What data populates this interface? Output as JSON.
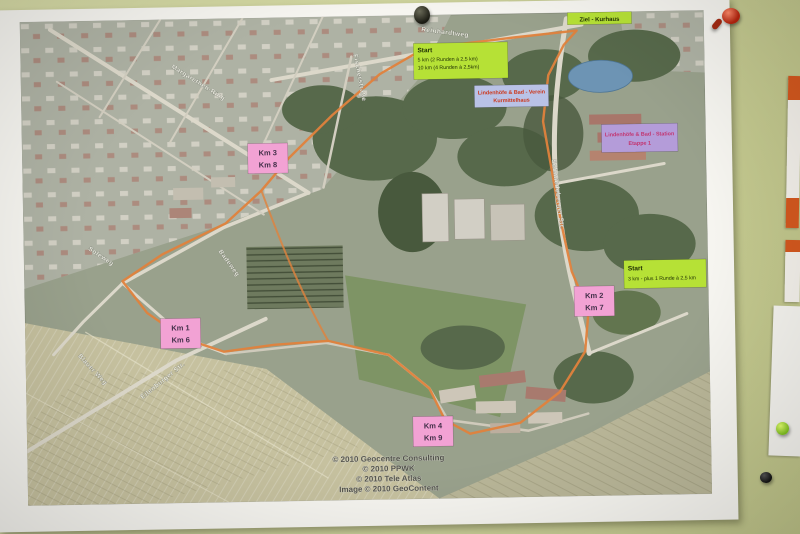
{
  "photo": {
    "labels": {
      "start_main": {
        "title": "Start",
        "line1": "5 km (2 Runden à 2,5 km)",
        "line2": "10 km (4 Runden à 2,5km)"
      },
      "finish": {
        "text": "Ziel - Kurhaus"
      },
      "club": {
        "line1": "Lindenhöfe & Bad - Verein",
        "line2": "Kurmittelhaus"
      },
      "station": {
        "line1": "Lindenhöfe & Bad - Station",
        "line2": "Etappe 1"
      },
      "start_right": {
        "title": "Start",
        "line1": "3 km - plus 1 Runde à 2,5 km"
      }
    },
    "km_markers": [
      {
        "top": "Km 3",
        "bottom": "Km 8"
      },
      {
        "top": "Km 1",
        "bottom": "Km 6"
      },
      {
        "top": "Km 2",
        "bottom": "Km 7"
      },
      {
        "top": "Km 4",
        "bottom": "Km 9"
      }
    ],
    "streets": {
      "reinhardtweg": "Reinhardtweg",
      "margarethen_ring": "Margarethen-Ring",
      "fischerstrasse": "Fischerstraße",
      "soleweg": "Soleweg",
      "badeweg": "Badeweg",
      "blauer_weg": "Blauer Weg",
      "eilenburger_str": "Eilenburger Str.",
      "schmiedeberger_str": "Schmiedeberger Str."
    },
    "copyright": {
      "line1": "© 2010 Geocentre Consulting",
      "line2": "© 2010 PPWK",
      "line3": "© 2010 Tele Atlas",
      "line4": "Image © 2010 GeoContent"
    },
    "colors": {
      "route": "#e0823c",
      "km_box": "#f2a2d4",
      "start_box": "#b6e136",
      "club_box": "#b9c2e6",
      "station_box": "#b49cd9",
      "board": "#ced3a0",
      "pond": "#6d94b4"
    }
  }
}
